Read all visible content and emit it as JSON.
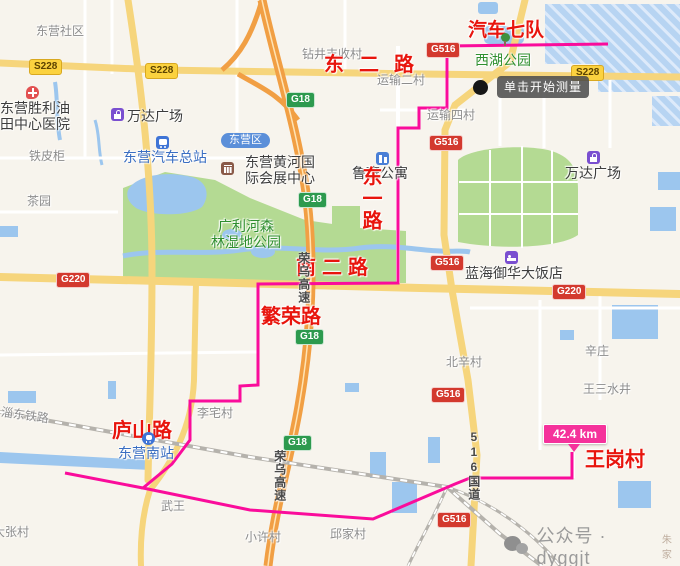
{
  "map": {
    "tooltip": "单击开始测量",
    "distance_badge": "42.4 km",
    "watermark": {
      "text": "公众号 · dyggjt",
      "suffix": "朱家"
    },
    "colors": {
      "route": "#fa0c9b",
      "balloon": "#f5329b",
      "highway_orange": "#f19f44",
      "arterial_yellow": "#f6d57c",
      "park_green": "#b4da93",
      "water_blue": "#9cc6ee",
      "red_label": "#e8150d"
    }
  },
  "elements": [
    {
      "name": "village-dongying-shequ",
      "kind": "label",
      "cls": "village",
      "text": "东营社区",
      "x": 36,
      "y": 25,
      "interactable": false
    },
    {
      "name": "village-zuanjing-fengshou",
      "kind": "label",
      "cls": "village",
      "text": "钻井丰收村",
      "x": 302,
      "y": 48,
      "interactable": false
    },
    {
      "name": "village-yunshu-2",
      "kind": "label",
      "cls": "village",
      "text": "运输二村",
      "x": 377,
      "y": 74,
      "interactable": false
    },
    {
      "name": "village-yunshu-4",
      "kind": "label",
      "cls": "village",
      "text": "运输四村",
      "x": 427,
      "y": 109,
      "interactable": false
    },
    {
      "name": "village-tiepigui",
      "kind": "label",
      "cls": "village",
      "text": "铁皮柜",
      "x": 29,
      "y": 150,
      "interactable": false
    },
    {
      "name": "village-chayuan",
      "kind": "label",
      "cls": "village",
      "text": "茶园",
      "x": 27,
      "y": 195,
      "interactable": false
    },
    {
      "name": "village-beixin",
      "kind": "label",
      "cls": "village",
      "text": "北辛村",
      "x": 446,
      "y": 356,
      "interactable": false
    },
    {
      "name": "village-xinzhuang",
      "kind": "label",
      "cls": "village",
      "text": "辛庄",
      "x": 585,
      "y": 345,
      "interactable": false
    },
    {
      "name": "village-wangsan-shuijing",
      "kind": "label",
      "cls": "village",
      "text": "王三水井",
      "x": 583,
      "y": 383,
      "interactable": false
    },
    {
      "name": "village-lizhai",
      "kind": "label",
      "cls": "village",
      "text": "李宅村",
      "x": 197,
      "y": 407,
      "interactable": false
    },
    {
      "name": "village-wuwang",
      "kind": "label",
      "cls": "village",
      "text": "武王",
      "x": 161,
      "y": 500,
      "interactable": false
    },
    {
      "name": "village-xiaoxu",
      "kind": "label",
      "cls": "village",
      "text": "小许村",
      "x": 245,
      "y": 531,
      "interactable": false
    },
    {
      "name": "village-qiujia",
      "kind": "label",
      "cls": "village",
      "text": "邱家村",
      "x": 330,
      "y": 528,
      "interactable": false
    },
    {
      "name": "village-zhangcun",
      "kind": "label",
      "cls": "village",
      "text": "大张村",
      "x": -7,
      "y": 526,
      "interactable": false
    },
    {
      "name": "railway-name",
      "kind": "label",
      "cls": "village rot9",
      "text": "淄东铁路",
      "x": 2,
      "y": 406,
      "interactable": false
    },
    {
      "name": "poi-wanda-plaza-west",
      "kind": "label",
      "cls": "poi-dark",
      "text": "万达广场",
      "x": 127,
      "y": 108,
      "interactable": true
    },
    {
      "name": "poi-wanda-plaza-east",
      "kind": "label",
      "cls": "poi-dark",
      "text": "万达广场",
      "x": 565,
      "y": 165,
      "interactable": true
    },
    {
      "name": "poi-shengli-hospital",
      "kind": "label",
      "cls": "poi-dark",
      "text": "东营胜利油\n田中心医院",
      "x": 0,
      "y": 100,
      "interactable": true
    },
    {
      "name": "poi-exhibition-center",
      "kind": "label",
      "cls": "poi-dark",
      "text": "东营黄河国\n际会展中心",
      "x": 245,
      "y": 154,
      "interactable": true
    },
    {
      "name": "poi-luban-apartment",
      "kind": "label",
      "cls": "poi-dark",
      "text": "鲁班公寓",
      "x": 352,
      "y": 165,
      "interactable": true
    },
    {
      "name": "poi-lanhai-hotel",
      "kind": "label",
      "cls": "poi-dark",
      "text": "蓝海御华大饭店",
      "x": 465,
      "y": 265,
      "interactable": true
    },
    {
      "name": "poi-bus-terminal",
      "kind": "label",
      "cls": "poi-blue",
      "text": "东营汽车总站",
      "x": 123,
      "y": 149,
      "interactable": true
    },
    {
      "name": "poi-dongying-south-station",
      "kind": "label",
      "cls": "poi-blue",
      "text": "东营南站",
      "x": 118,
      "y": 445,
      "interactable": true
    },
    {
      "name": "poi-xihu-park",
      "kind": "label",
      "cls": "poi-green",
      "text": "西湖公园",
      "x": 475,
      "y": 52,
      "interactable": true
    },
    {
      "name": "poi-guanglihe-wetland-park",
      "kind": "label",
      "cls": "poi-green",
      "text": "广利河森\n林湿地公园",
      "x": 211,
      "y": 218,
      "interactable": true
    },
    {
      "name": "route-label-qiche-qidui",
      "kind": "label",
      "cls": "road-red fs19",
      "text": "汽车七队",
      "x": 468,
      "y": 20,
      "interactable": false
    },
    {
      "name": "route-label-dong-er-lu",
      "kind": "label",
      "cls": "road-red ls15",
      "text": "东二路",
      "x": 324,
      "y": 54,
      "interactable": false
    },
    {
      "name": "route-label-dong-yi-lu",
      "kind": "label",
      "cls": "road-red vert",
      "text": "东一路",
      "x": 358,
      "y": 166,
      "interactable": false
    },
    {
      "name": "route-label-nan-er-lu",
      "kind": "label",
      "cls": "road-red ls6",
      "text": "南二路",
      "x": 296,
      "y": 257,
      "interactable": false
    },
    {
      "name": "route-label-fanrong-lu",
      "kind": "label",
      "cls": "road-red",
      "text": "繁荣路",
      "x": 261,
      "y": 306,
      "interactable": false
    },
    {
      "name": "route-label-lushan-lu",
      "kind": "label",
      "cls": "road-red",
      "text": "庐山路",
      "x": 112,
      "y": 420,
      "interactable": false
    },
    {
      "name": "route-label-wanggang-cun",
      "kind": "label",
      "cls": "road-red",
      "text": "王岗村",
      "x": 585,
      "y": 449,
      "interactable": false
    },
    {
      "name": "roadname-rongwu-expwy-north",
      "kind": "label",
      "cls": "road-vert",
      "text": "荣乌高速",
      "x": 296,
      "y": 252,
      "interactable": false
    },
    {
      "name": "roadname-rongwu-expwy-south",
      "kind": "label",
      "cls": "road-vert",
      "text": "荣乌高速",
      "x": 272,
      "y": 450,
      "interactable": false
    },
    {
      "name": "roadname-516-guodao",
      "kind": "label",
      "cls": "road-vert",
      "text": "516国道",
      "x": 466,
      "y": 430,
      "interactable": false
    },
    {
      "name": "badge-g516-1",
      "kind": "label",
      "cls": "badge badge-red",
      "text": "G516",
      "x": 426,
      "y": 42,
      "interactable": false
    },
    {
      "name": "badge-g516-2",
      "kind": "label",
      "cls": "badge badge-red",
      "text": "G516",
      "x": 429,
      "y": 135,
      "interactable": false
    },
    {
      "name": "badge-g516-3",
      "kind": "label",
      "cls": "badge badge-red",
      "text": "G516",
      "x": 430,
      "y": 255,
      "interactable": false
    },
    {
      "name": "badge-g516-4",
      "kind": "label",
      "cls": "badge badge-red",
      "text": "G516",
      "x": 431,
      "y": 387,
      "interactable": false
    },
    {
      "name": "badge-g516-5",
      "kind": "label",
      "cls": "badge badge-red",
      "text": "G516",
      "x": 437,
      "y": 512,
      "interactable": false
    },
    {
      "name": "badge-g18-1",
      "kind": "label",
      "cls": "badge badge-green",
      "text": "G18",
      "x": 286,
      "y": 92,
      "interactable": false
    },
    {
      "name": "badge-g18-2",
      "kind": "label",
      "cls": "badge badge-green",
      "text": "G18",
      "x": 298,
      "y": 192,
      "interactable": false
    },
    {
      "name": "badge-g18-3",
      "kind": "label",
      "cls": "badge badge-green",
      "text": "G18",
      "x": 295,
      "y": 329,
      "interactable": false
    },
    {
      "name": "badge-g18-4",
      "kind": "label",
      "cls": "badge badge-green",
      "text": "G18",
      "x": 283,
      "y": 435,
      "interactable": false
    },
    {
      "name": "badge-s228-1",
      "kind": "label",
      "cls": "badge badge-yellow",
      "text": "S228",
      "x": 29,
      "y": 59,
      "interactable": false
    },
    {
      "name": "badge-s228-2",
      "kind": "label",
      "cls": "badge badge-yellow",
      "text": "S228",
      "x": 145,
      "y": 63,
      "interactable": false
    },
    {
      "name": "badge-s228-3",
      "kind": "label",
      "cls": "badge badge-yellow",
      "text": "S228",
      "x": 571,
      "y": 65,
      "interactable": false
    },
    {
      "name": "badge-g220-1",
      "kind": "label",
      "cls": "badge badge-red",
      "text": "G220",
      "x": 56,
      "y": 272,
      "interactable": false
    },
    {
      "name": "badge-g220-2",
      "kind": "label",
      "cls": "badge badge-red",
      "text": "G220",
      "x": 552,
      "y": 284,
      "interactable": false
    },
    {
      "name": "badge-dongying-district",
      "kind": "label",
      "cls": "badge-district",
      "text": "东营区",
      "x": 221,
      "y": 133,
      "interactable": false
    },
    {
      "name": "hospital-icon",
      "kind": "icon",
      "cls": "icon icon-hospital",
      "x": 26,
      "y": 86,
      "interactable": true
    },
    {
      "name": "mall-icon-west",
      "kind": "icon",
      "cls": "icon icon-mall",
      "x": 111,
      "y": 108,
      "interactable": true
    },
    {
      "name": "mall-icon-east",
      "kind": "icon",
      "cls": "icon icon-mall",
      "x": 587,
      "y": 151,
      "interactable": true
    },
    {
      "name": "bus-icon",
      "kind": "icon",
      "cls": "icon icon-bus",
      "x": 156,
      "y": 136,
      "interactable": true
    },
    {
      "name": "train-icon",
      "kind": "icon",
      "cls": "icon icon-train",
      "x": 142,
      "y": 432,
      "interactable": true
    },
    {
      "name": "exhibition-icon",
      "kind": "icon",
      "cls": "icon icon-build",
      "x": 221,
      "y": 162,
      "interactable": true
    },
    {
      "name": "apartment-icon",
      "kind": "icon",
      "cls": "icon icon-apart",
      "x": 376,
      "y": 152,
      "interactable": true
    },
    {
      "name": "hotel-icon",
      "kind": "icon",
      "cls": "icon icon-hotel",
      "x": 505,
      "y": 251,
      "interactable": true
    },
    {
      "name": "tree-icon",
      "kind": "icon",
      "cls": "icon icon-tree",
      "x": 498,
      "y": 33,
      "interactable": false
    },
    {
      "name": "measure-point-dot",
      "kind": "icon",
      "cls": "black-dot",
      "x": 473,
      "y": 80,
      "interactable": false
    }
  ]
}
